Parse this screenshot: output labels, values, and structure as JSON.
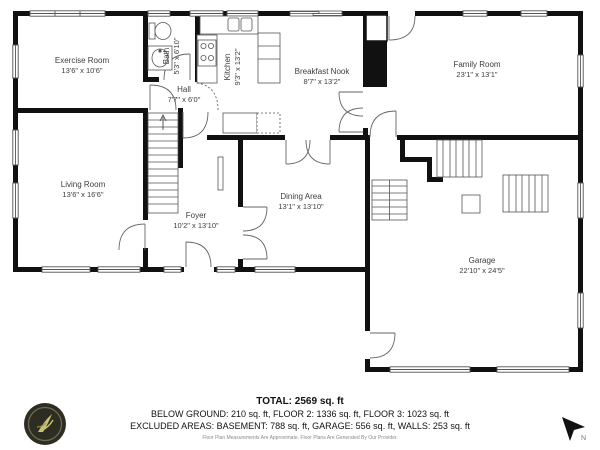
{
  "plan": {
    "rooms": [
      {
        "id": "exercise-room",
        "name": "Exercise Room",
        "dims": "13'6\" x 10'6\"",
        "x": 82,
        "y": 66,
        "rotate": 0
      },
      {
        "id": "bath",
        "name": "Bath",
        "dims": "5'3\" x 6'10\"",
        "x": 172,
        "y": 56,
        "rotate": 1
      },
      {
        "id": "kitchen",
        "name": "Kitchen",
        "dims": "9'3\" x 13'2\"",
        "x": 233,
        "y": 67,
        "rotate": 1
      },
      {
        "id": "breakfast-nook",
        "name": "Breakfast Nook",
        "dims": "8'7\" x 13'2\"",
        "x": 322,
        "y": 77,
        "rotate": 0
      },
      {
        "id": "family-room",
        "name": "Family Room",
        "dims": "23'1\" x 13'1\"",
        "x": 477,
        "y": 70,
        "rotate": 0
      },
      {
        "id": "hall",
        "name": "Hall",
        "dims": "7'7\" x 6'0\"",
        "x": 184,
        "y": 95,
        "rotate": 0
      },
      {
        "id": "living-room",
        "name": "Living Room",
        "dims": "13'6\" x 16'6\"",
        "x": 83,
        "y": 190,
        "rotate": 0
      },
      {
        "id": "foyer",
        "name": "Foyer",
        "dims": "10'2\" x 13'10\"",
        "x": 196,
        "y": 221,
        "rotate": 0
      },
      {
        "id": "dining-area",
        "name": "Dining Area",
        "dims": "13'1\" x 13'10\"",
        "x": 301,
        "y": 202,
        "rotate": 0
      },
      {
        "id": "garage",
        "name": "Garage",
        "dims": "22'10\" x 24'5\"",
        "x": 482,
        "y": 266,
        "rotate": 0
      }
    ]
  },
  "footer": {
    "total": "TOTAL: 2569 sq. ft",
    "line2": "BELOW GROUND: 210 sq. ft, FLOOR 2: 1336 sq. ft, FLOOR 3: 1023 sq. ft",
    "line3": "EXCLUDED AREAS: BASEMENT: 788 sq. ft, GARAGE: 556 sq. ft, WALLS: 253 sq. ft",
    "disclaimer": "Floor Plan Measurements Are Approximate. Floor Plans Are Generated By Our Provider."
  },
  "colors": {
    "wall": "#111111",
    "thin_line": "#555555",
    "label_text": "#3d3d3d",
    "logo_bg": "#2d2d24",
    "logo_accent": "#c9c273"
  }
}
